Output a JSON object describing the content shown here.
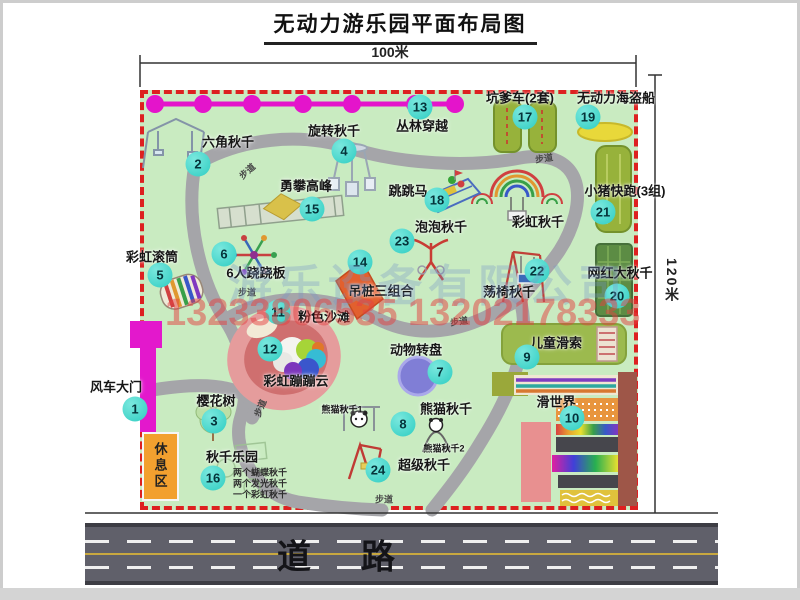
{
  "title": "无动力游乐园平面布局图",
  "dimensions": {
    "top": "100米",
    "right": "120米"
  },
  "watermarks": {
    "company": "游乐设备有限公司",
    "phone": "13233806535 13202178333"
  },
  "road": {
    "char1": "道",
    "char2": "路"
  },
  "rest_area": {
    "label": "休息区"
  },
  "trail_label": "步道",
  "trails": [
    {
      "x": 247,
      "y": 171,
      "r": -42
    },
    {
      "x": 544,
      "y": 158,
      "r": -8
    },
    {
      "x": 247,
      "y": 292,
      "r": 0
    },
    {
      "x": 459,
      "y": 321,
      "r": -8
    },
    {
      "x": 260,
      "y": 408,
      "r": -68
    },
    {
      "x": 384,
      "y": 499,
      "r": 0
    }
  ],
  "attractions": [
    {
      "num": "1",
      "label": "风车大门",
      "nx": 135,
      "ny": 409,
      "lx": 116,
      "ly": 386
    },
    {
      "num": "2",
      "label": "六角秋千",
      "nx": 198,
      "ny": 164,
      "lx": 228,
      "ly": 141
    },
    {
      "num": "3",
      "label": "樱花树",
      "nx": 214,
      "ny": 421,
      "lx": 216,
      "ly": 400
    },
    {
      "num": "4",
      "label": "旋转秋千",
      "nx": 344,
      "ny": 151,
      "lx": 334,
      "ly": 130
    },
    {
      "num": "5",
      "label": "彩虹滚筒",
      "nx": 160,
      "ny": 275,
      "lx": 152,
      "ly": 256
    },
    {
      "num": "6",
      "label": "6人跷跷板",
      "nx": 224,
      "ny": 254,
      "lx": 256,
      "ly": 272
    },
    {
      "num": "7",
      "label": "动物转盘",
      "nx": 440,
      "ny": 372,
      "lx": 416,
      "ly": 349
    },
    {
      "num": "8",
      "label": "熊猫秋千",
      "nx": 403,
      "ny": 424,
      "lx": 446,
      "ly": 408
    },
    {
      "num": "9",
      "label": "儿童滑索",
      "nx": 527,
      "ny": 357,
      "lx": 556,
      "ly": 342
    },
    {
      "num": "10",
      "label": "滑世界",
      "nx": 572,
      "ny": 418,
      "lx": 556,
      "ly": 401
    },
    {
      "num": "11",
      "label": "粉色沙滩",
      "nx": 278,
      "ny": 312,
      "lx": 324,
      "ly": 316
    },
    {
      "num": "12",
      "label": "彩虹蹦蹦云",
      "nx": 270,
      "ny": 349,
      "lx": 296,
      "ly": 380
    },
    {
      "num": "13",
      "label": "丛林穿越",
      "nx": 420,
      "ny": 107,
      "lx": 422,
      "ly": 125
    },
    {
      "num": "14",
      "label": "吊桩三组合",
      "nx": 360,
      "ny": 262,
      "lx": 381,
      "ly": 290
    },
    {
      "num": "15",
      "label": "勇攀高峰",
      "nx": 312,
      "ny": 209,
      "lx": 306,
      "ly": 185
    },
    {
      "num": "16",
      "label": "秋千乐园",
      "nx": 213,
      "ny": 478,
      "lx": 232,
      "ly": 456
    },
    {
      "num": "17",
      "label": "坑爹车(2套)",
      "nx": 525,
      "ny": 117,
      "lx": 520,
      "ly": 97
    },
    {
      "num": "18",
      "label": "跳跳马",
      "nx": 437,
      "ny": 200,
      "lx": 408,
      "ly": 190
    },
    {
      "num": "19",
      "label": "无动力海盗船",
      "nx": 588,
      "ny": 117,
      "lx": 616,
      "ly": 97
    },
    {
      "num": "20",
      "label": "网红大秋千",
      "nx": 617,
      "ny": 296,
      "lx": 620,
      "ly": 272
    },
    {
      "num": "21",
      "label": "小猪快跑(3组)",
      "nx": 603,
      "ny": 212,
      "lx": 625,
      "ly": 190
    },
    {
      "num": "22",
      "label": "荡椅秋千",
      "nx": 537,
      "ny": 271,
      "lx": 509,
      "ly": 291
    },
    {
      "num": "23",
      "label": "泡泡秋千",
      "nx": 402,
      "ny": 241,
      "lx": 441,
      "ly": 226
    },
    {
      "num": "24",
      "label": "超级秋千",
      "nx": 378,
      "ny": 470,
      "lx": 424,
      "ly": 464
    }
  ],
  "extra_labels": [
    {
      "label": "彩虹秋千",
      "x": 538,
      "y": 221,
      "small": false
    },
    {
      "label": "熊猫秋千1",
      "x": 342,
      "y": 409,
      "small": true
    },
    {
      "label": "熊猫秋千2",
      "x": 444,
      "y": 448,
      "small": true
    }
  ],
  "swing_park_notes": [
    "两个蝴蝶秋千",
    "两个发光秋千",
    "一个彩虹秋千"
  ],
  "colors": {
    "map_green": "#c9ebc1",
    "border_red": "#dd2020",
    "marker_teal": "#2fcdc2",
    "zipline_magenta": "#e414cb",
    "gate_magenta": "#e318cc",
    "rest_orange": "#f2a02f",
    "road_gray": "#60606a",
    "road_yellow": "#c8a840"
  }
}
